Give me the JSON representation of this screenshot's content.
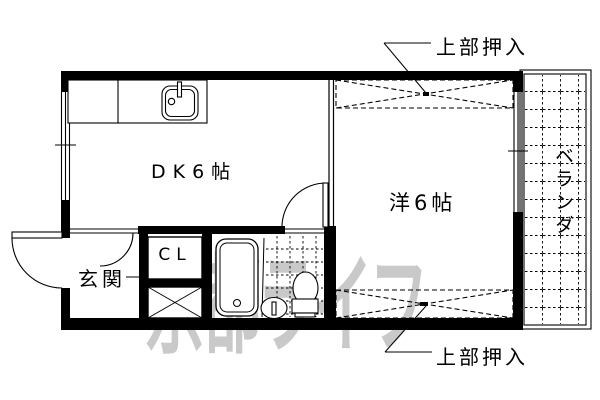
{
  "document": {
    "type": "apartment-floorplan",
    "background": "#ffffff"
  },
  "rooms": {
    "dk": {
      "label": "DK6帖"
    },
    "western_room": {
      "label": "洋6帖"
    },
    "entrance": {
      "label": "玄関"
    },
    "closet": {
      "label": "CL"
    },
    "veranda": {
      "label": "ベランダ"
    }
  },
  "annotations": {
    "upper_closet_top": "上部押入",
    "upper_closet_bottom": "上部押入"
  },
  "watermark": {
    "text": "京都ライフ",
    "color": "#c9c9c9"
  },
  "fixtures": [
    "kitchen-sink",
    "bathtub",
    "toilet",
    "washbasin",
    "tiled-floor"
  ],
  "colors": {
    "line": "#000000",
    "background": "#ffffff",
    "watermark": "#c9c9c9"
  }
}
